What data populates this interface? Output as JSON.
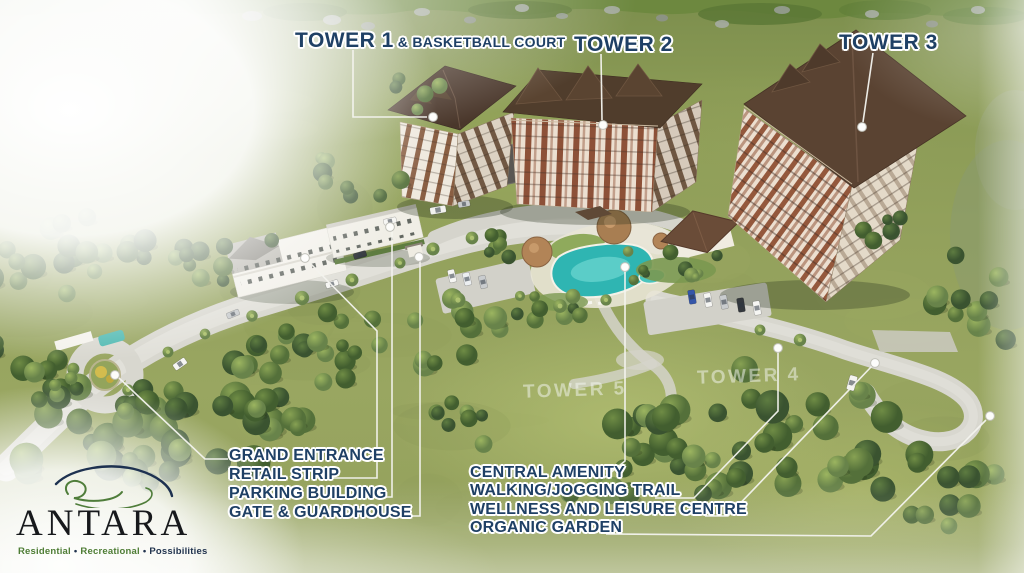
{
  "scene_title": "ANTARA site development aerial view",
  "tower_labels": [
    {
      "main": "TOWER 1",
      "suffix": "& BASKETBALL COURT"
    },
    {
      "main": "TOWER 2",
      "suffix": ""
    },
    {
      "main": "TOWER 3",
      "suffix": ""
    }
  ],
  "left_callouts": {
    "items": [
      "GRAND ENTRANCE",
      "RETAIL STRIP",
      "PARKING BUILDING",
      "GATE & GUARDHOUSE"
    ]
  },
  "center_callouts": {
    "items": [
      "CENTRAL AMENITY",
      "WALKING/JOGGING TRAIL",
      "WELLNESS AND LEISURE CENTRE",
      "ORGANIC GARDEN"
    ]
  },
  "future_tower_watermarks": [
    "TOWER 5",
    "TOWER 4"
  ],
  "logo": {
    "name": "ANTARA",
    "tagline": [
      "Residential",
      "Recreational",
      "Possibilities"
    ],
    "bullet": "•"
  },
  "colors": {
    "label_text": "#1f4065",
    "leader_line": "#f4f4ef",
    "marker_dot": "#ffffff",
    "pool_teal": "#2fb5b2",
    "roof_brown": "#54402f",
    "road_gray": "#d8d7cf",
    "grass_green": "#93a15c",
    "logo_green": "#4e7d35",
    "logo_navy": "#1d3150"
  }
}
